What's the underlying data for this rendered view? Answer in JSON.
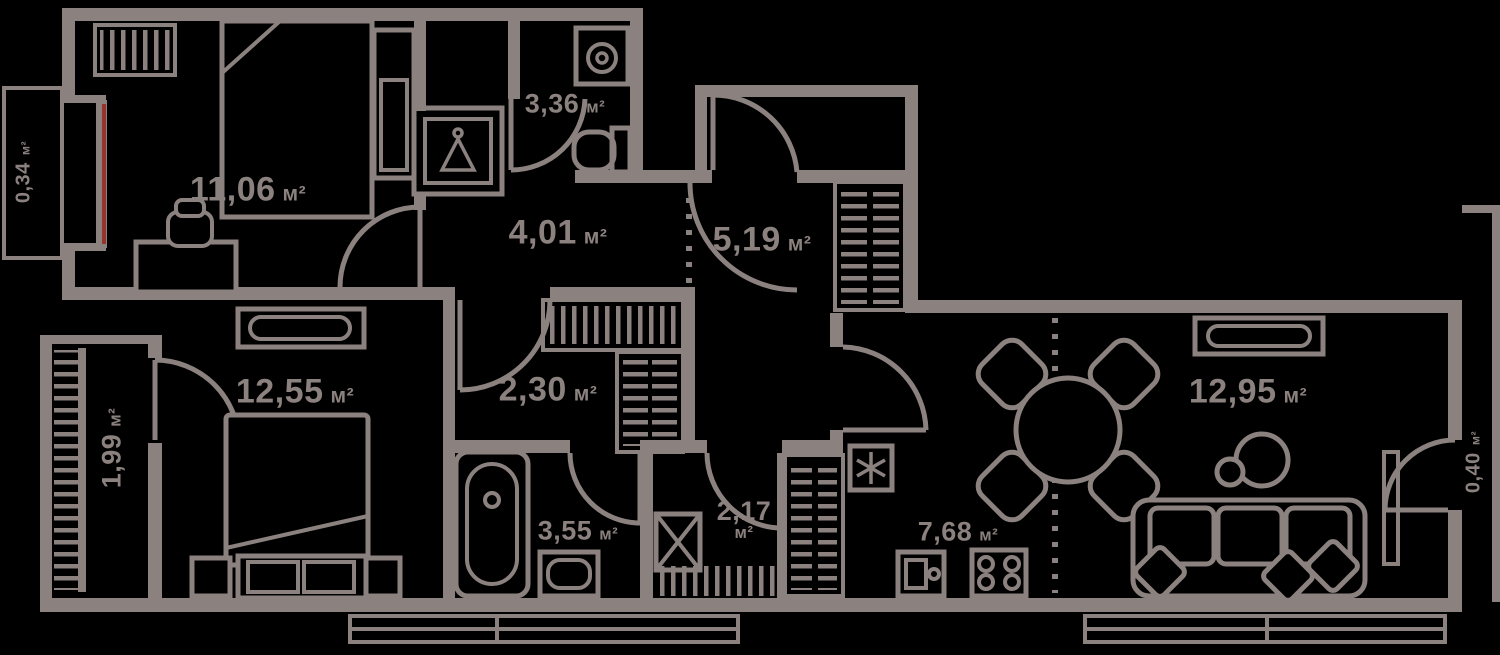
{
  "plan": {
    "type": "apartment-floor-plan",
    "background": "#000000",
    "wall_color": "#8b827f",
    "window_accent_red": "#96332c",
    "area_unit": "м²",
    "rooms": [
      {
        "id": "balcony-top-left",
        "value": "0,34",
        "unit": "м²"
      },
      {
        "id": "bedroom-top",
        "value": "11,06",
        "unit": "м²"
      },
      {
        "id": "bathroom-top",
        "value": "3,36",
        "unit": "м²"
      },
      {
        "id": "hallway",
        "value": "4,01",
        "unit": "м²"
      },
      {
        "id": "entrance-hall",
        "value": "5,19",
        "unit": "м²"
      },
      {
        "id": "bedroom-left",
        "value": "12,55",
        "unit": "м²"
      },
      {
        "id": "balcony-bottom-left",
        "value": "1,99",
        "unit": "м²"
      },
      {
        "id": "corridor",
        "value": "2,30",
        "unit": "м²"
      },
      {
        "id": "bathroom-bottom",
        "value": "3,55",
        "unit": "м²"
      },
      {
        "id": "laundry",
        "value": "2,17",
        "unit": "м²"
      },
      {
        "id": "kitchen",
        "value": "7,68",
        "unit": "м²"
      },
      {
        "id": "living-room",
        "value": "12,95",
        "unit": "м²"
      },
      {
        "id": "balcony-right",
        "value": "0,40",
        "unit": "м²"
      }
    ],
    "icons": [
      "radiator-icon",
      "double-bed",
      "bedside-cabinet",
      "desk",
      "chair",
      "wardrobe-hanger-icon",
      "washing-machine-icon",
      "toilet-icon",
      "entrance-door-arc",
      "door-arc",
      "closet-shelves",
      "bed",
      "bench-dresser",
      "bathtub-icon",
      "sink-icon",
      "washer-x-icon",
      "floor-hatch",
      "service-shaft",
      "fridge-snowflake-icon",
      "kitchen-sink-icon",
      "stove-icon",
      "dining-table",
      "dining-chair",
      "floor-lamp-icon",
      "sofa",
      "pillow",
      "console-table",
      "window",
      "balcony-railing",
      "red-window-line",
      "zone-dotted-line"
    ]
  }
}
